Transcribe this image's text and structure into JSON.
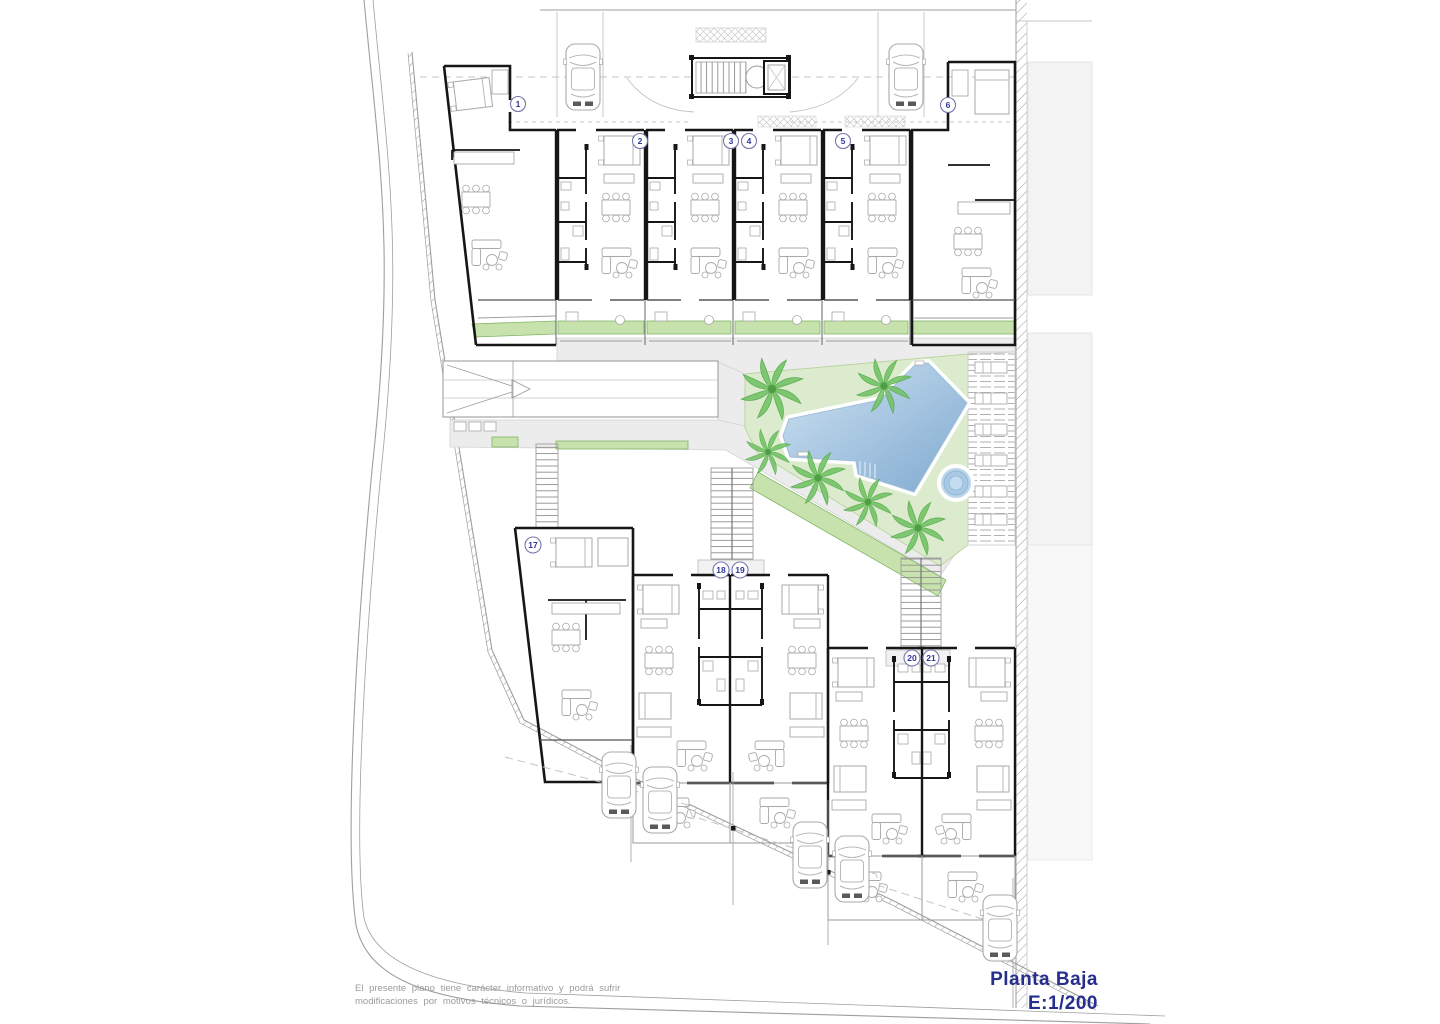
{
  "plan": {
    "title": {
      "name": "Planta Baja",
      "scale": "E:1/200"
    },
    "disclaimer": {
      "line1": "El presente plano tiene carácter informativo y podrá sufrir",
      "line2": "modificaciones por motivos técnicos o jurídicos."
    },
    "unit_badges": [
      {
        "label": "1"
      },
      {
        "label": "2"
      },
      {
        "label": "3"
      },
      {
        "label": "4"
      },
      {
        "label": "5"
      },
      {
        "label": "6"
      },
      {
        "label": "17"
      },
      {
        "label": "18"
      },
      {
        "label": "19"
      },
      {
        "label": "20"
      },
      {
        "label": "21"
      }
    ],
    "features": {
      "pool": "swimming-pool",
      "jacuzzi": "round-spa",
      "palms": "palm-trees",
      "deck": "sun-deck-with-loungers",
      "ramp": "garage-ramp",
      "stairs": "staircases",
      "parking": "surface-parking-with-cars"
    }
  },
  "colors": {
    "title_text": "#262e8e",
    "badge_text": "#31379b",
    "lawn": "#dcebcd",
    "garden_strip": "#c8e2ae",
    "pool_light": "#cfe3f2",
    "pool_dark": "#7fa9d0",
    "path_gray": "#ececec",
    "neighbor_gray": "#f3f3f3",
    "wall_black": "#161616",
    "disclaimer_gray": "#9b9b9b"
  }
}
